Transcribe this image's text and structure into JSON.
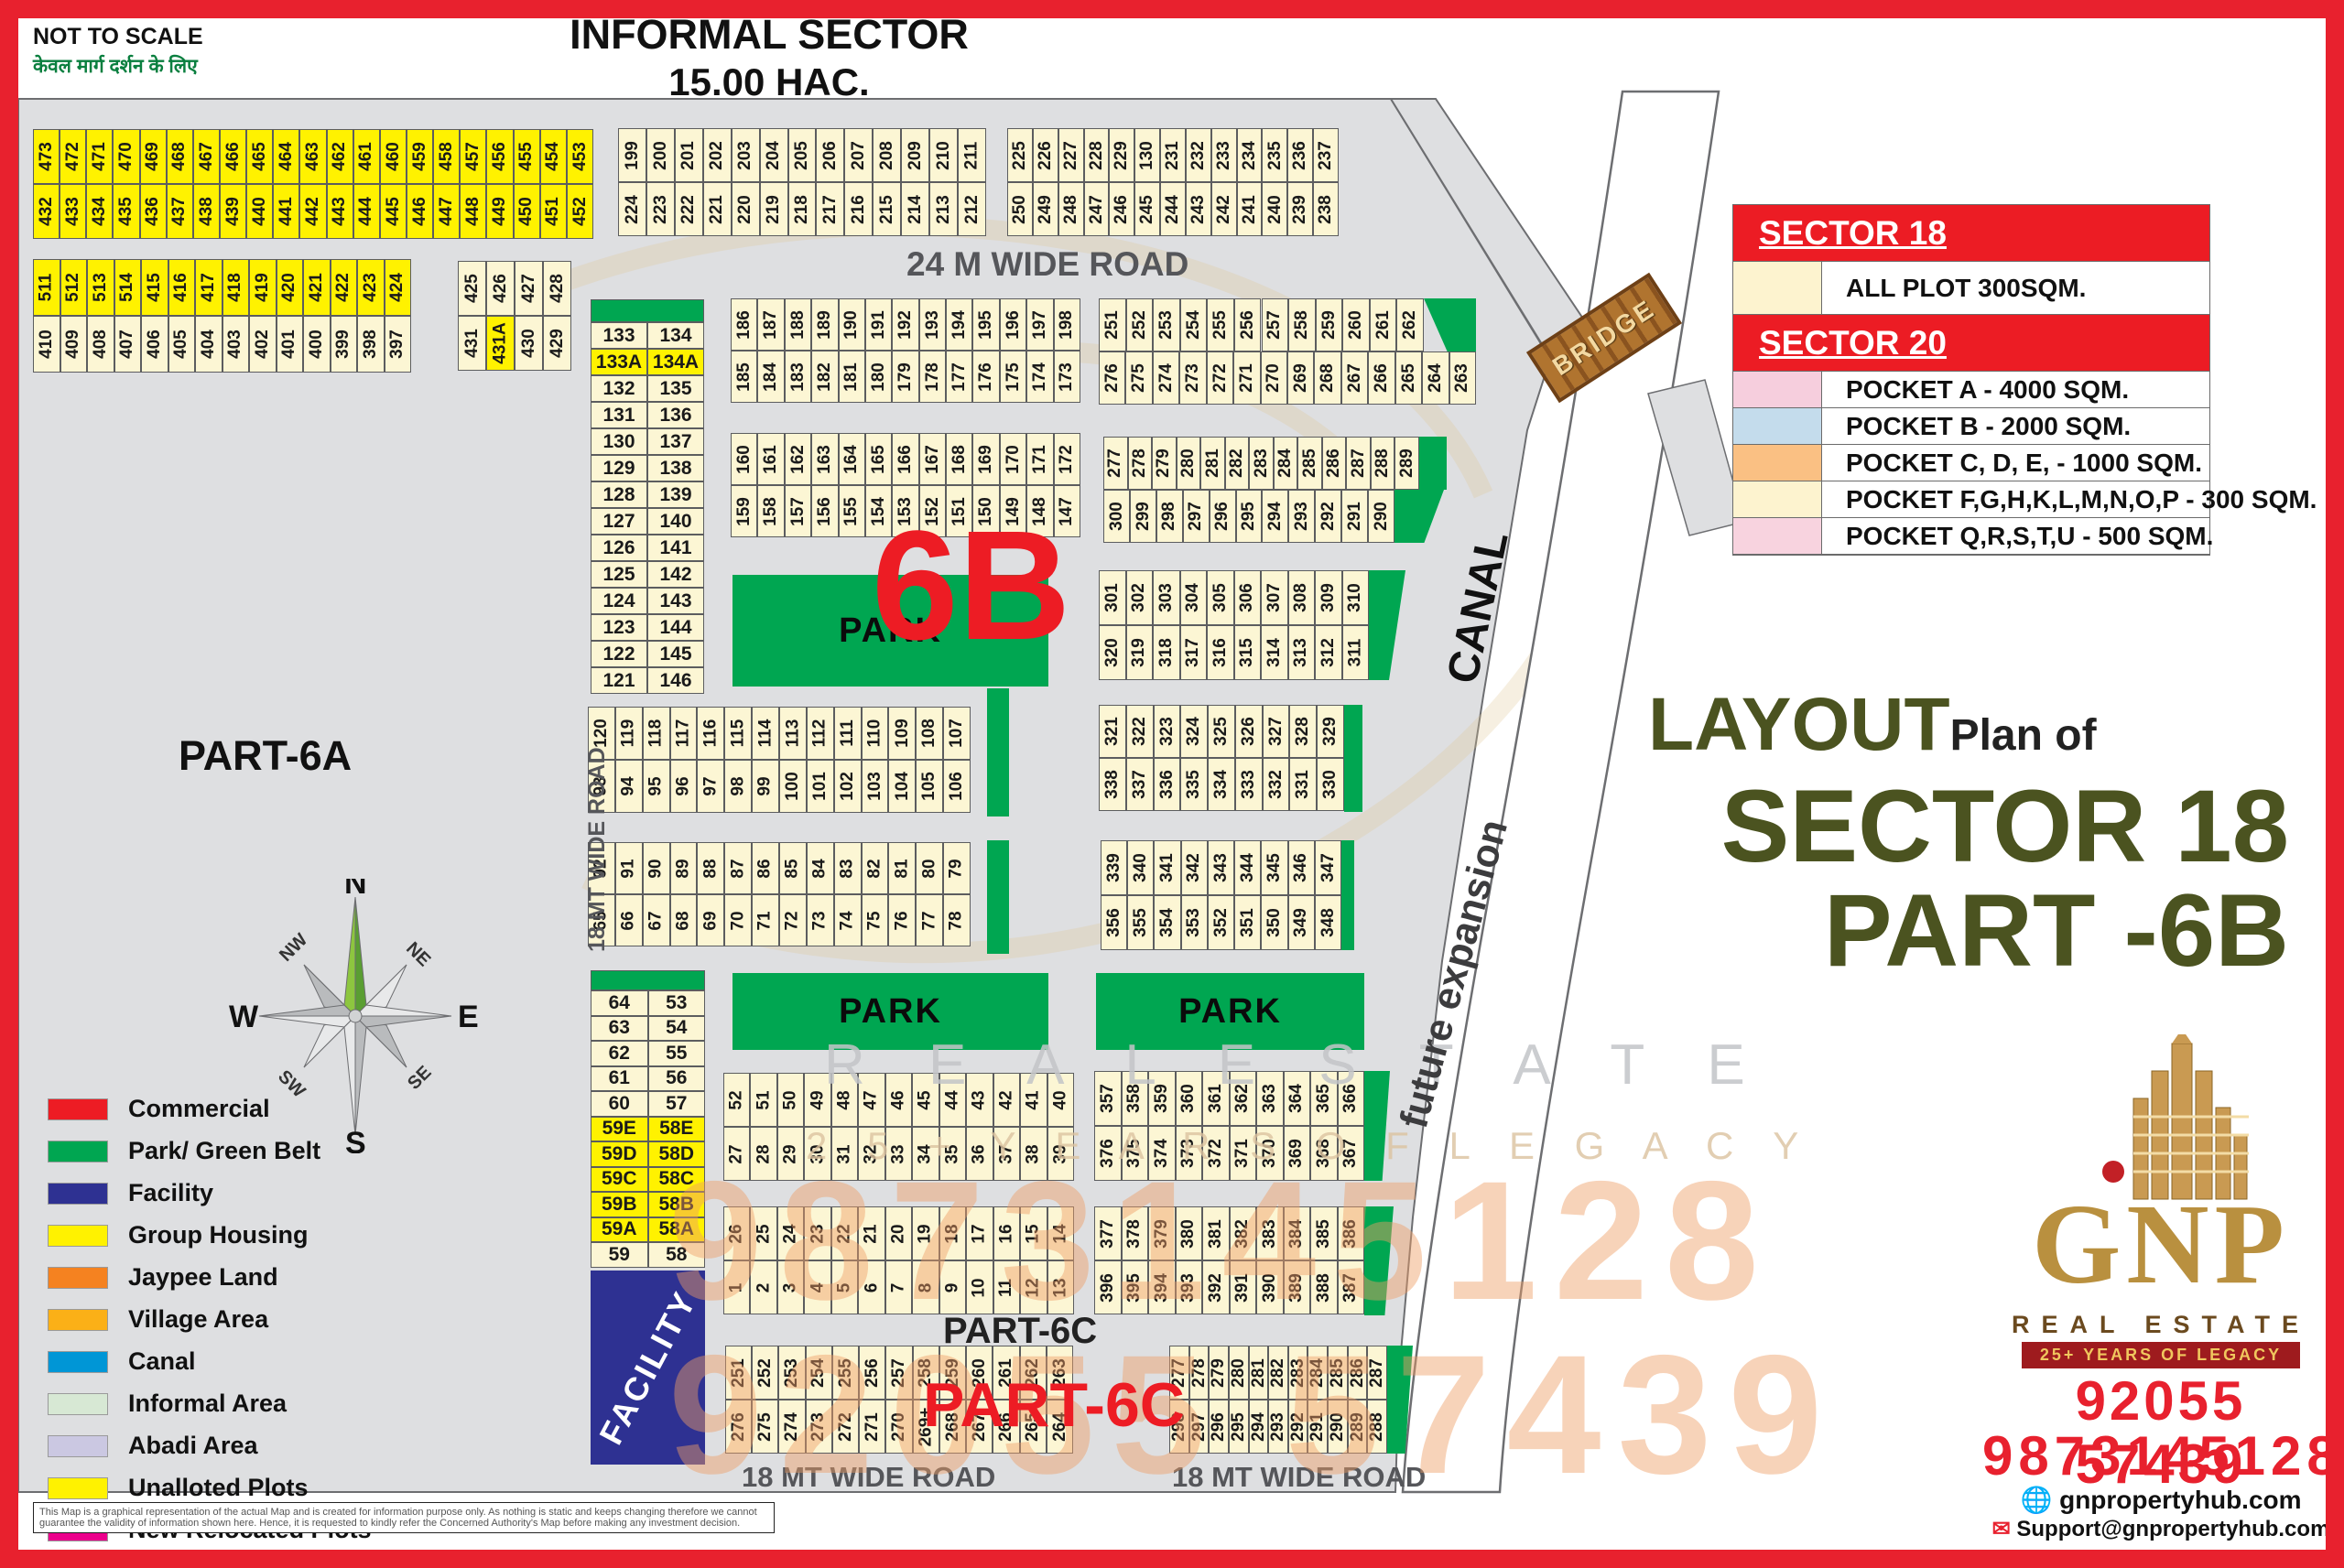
{
  "labels": {
    "not_to_scale": "NOT TO SCALE",
    "hindi": "केवल मार्ग दर्शन के लिए",
    "informal_1": "INFORMAL SECTOR",
    "informal_2": "15.00 HAC.",
    "road24": "24 M WIDE ROAD",
    "road18v": "18 MT WIDE ROAD",
    "road18a": "18 MT WIDE ROAD",
    "road18b": "18 MT WIDE ROAD",
    "part6a": "PART-6A",
    "part6c_black": "PART-6C",
    "part6c_red": "PART-6C",
    "six_b": "6B",
    "canal": "CANAL",
    "future_expansion": "future expansion",
    "bridge": "BRIDGE",
    "layout": "LAYOUT",
    "plan_of": "Plan of",
    "sector18_title": "SECTOR 18",
    "part6b_title": "PART -6B"
  },
  "compass": {
    "n": "N",
    "s": "S",
    "e": "E",
    "w": "W",
    "ne": "NE",
    "nw": "NW",
    "se": "SE",
    "sw": "SW"
  },
  "parks": [
    {
      "id": "park-6b",
      "label": "PARK"
    },
    {
      "id": "park-mid",
      "label": "PARK"
    },
    {
      "id": "park-right",
      "label": "PARK"
    }
  ],
  "facility_label": "FACILITY",
  "plot_blocks": [
    {
      "id": "b1",
      "kind": "slat",
      "yellow": "all",
      "rows": [
        [
          "473",
          "472",
          "471",
          "470",
          "469",
          "468",
          "467",
          "466",
          "465",
          "464",
          "463",
          "462",
          "461",
          "460",
          "459",
          "458",
          "457",
          "456",
          "455",
          "454",
          "453"
        ],
        [
          "432",
          "433",
          "434",
          "435",
          "436",
          "437",
          "438",
          "439",
          "440",
          "441",
          "442",
          "443",
          "444",
          "445",
          "446",
          "447",
          "448",
          "449",
          "450",
          "451",
          "452"
        ]
      ]
    },
    {
      "id": "b2",
      "kind": "slat",
      "yellowRows": [
        0
      ],
      "rows": [
        [
          "511",
          "512",
          "513",
          "514",
          "415",
          "416",
          "417",
          "418",
          "419",
          "420",
          "421",
          "422",
          "423",
          "424"
        ],
        [
          "410",
          "409",
          "408",
          "407",
          "406",
          "405",
          "404",
          "403",
          "402",
          "401",
          "400",
          "399",
          "398",
          "397"
        ]
      ]
    },
    {
      "id": "b3",
      "kind": "slat",
      "yellowCells": [
        "431A"
      ],
      "rows": [
        [
          "425",
          "426",
          "427",
          "428"
        ],
        [
          "431",
          "431A",
          "430",
          "429"
        ]
      ]
    },
    {
      "id": "b4",
      "kind": "slat",
      "rows": [
        [
          "199",
          "200",
          "201",
          "202",
          "203",
          "204",
          "205",
          "206",
          "207",
          "208",
          "209",
          "210",
          "211"
        ],
        [
          "224",
          "223",
          "222",
          "221",
          "220",
          "219",
          "218",
          "217",
          "216",
          "215",
          "214",
          "213",
          "212"
        ]
      ]
    },
    {
      "id": "b5",
      "kind": "slat",
      "rows": [
        [
          "225",
          "226",
          "227",
          "228",
          "229",
          "130",
          "231",
          "232",
          "233",
          "234",
          "235",
          "236",
          "237"
        ],
        [
          "250",
          "249",
          "248",
          "247",
          "246",
          "245",
          "244",
          "243",
          "242",
          "241",
          "240",
          "239",
          "238"
        ]
      ]
    },
    {
      "id": "c1",
      "kind": "table",
      "yellowCells": [
        "133A",
        "134A"
      ],
      "rows": [
        [
          "133",
          "134"
        ],
        [
          "133A",
          "134A"
        ],
        [
          "132",
          "135"
        ],
        [
          "131",
          "136"
        ],
        [
          "130",
          "137"
        ],
        [
          "129",
          "138"
        ],
        [
          "128",
          "139"
        ],
        [
          "127",
          "140"
        ],
        [
          "126",
          "141"
        ],
        [
          "125",
          "142"
        ],
        [
          "124",
          "143"
        ],
        [
          "123",
          "144"
        ],
        [
          "122",
          "145"
        ],
        [
          "121",
          "146"
        ]
      ]
    },
    {
      "id": "c2",
      "kind": "slat",
      "rows": [
        [
          "186",
          "187",
          "188",
          "189",
          "190",
          "191",
          "192",
          "193",
          "194",
          "195",
          "196",
          "197",
          "198"
        ],
        [
          "185",
          "184",
          "183",
          "182",
          "181",
          "180",
          "179",
          "178",
          "177",
          "176",
          "175",
          "174",
          "173"
        ]
      ]
    },
    {
      "id": "c3",
      "kind": "slat",
      "rows": [
        [
          "160",
          "161",
          "162",
          "163",
          "164",
          "165",
          "166",
          "167",
          "168",
          "169",
          "170",
          "171",
          "172"
        ],
        [
          "159",
          "158",
          "157",
          "156",
          "155",
          "154",
          "153",
          "152",
          "151",
          "150",
          "149",
          "148",
          "147"
        ]
      ]
    },
    {
      "id": "c4",
      "kind": "slat",
      "rows": [
        [
          "251",
          "252",
          "253",
          "254",
          "255",
          "256",
          "257",
          "258",
          "259",
          "260",
          "261",
          "262"
        ],
        [
          "276",
          "275",
          "274",
          "273",
          "272",
          "271",
          "270",
          "269",
          "268",
          "267",
          "266",
          "265",
          "264",
          "263"
        ]
      ]
    },
    {
      "id": "c5",
      "kind": "slat",
      "rows": [
        [
          "277",
          "278",
          "279",
          "280",
          "281",
          "282",
          "283",
          "284",
          "285",
          "286",
          "287",
          "288",
          "289"
        ],
        [
          "300",
          "299",
          "298",
          "297",
          "296",
          "295",
          "294",
          "293",
          "292",
          "291",
          "290"
        ]
      ]
    },
    {
      "id": "c6",
      "kind": "slat",
      "rows": [
        [
          "301",
          "302",
          "303",
          "304",
          "305",
          "306",
          "307",
          "308",
          "309",
          "310"
        ],
        [
          "320",
          "319",
          "318",
          "317",
          "316",
          "315",
          "314",
          "313",
          "312",
          "311"
        ]
      ]
    },
    {
      "id": "c7",
      "kind": "slat",
      "rows": [
        [
          "321",
          "322",
          "323",
          "324",
          "325",
          "326",
          "327",
          "328",
          "329"
        ],
        [
          "338",
          "337",
          "336",
          "335",
          "334",
          "333",
          "332",
          "331",
          "330"
        ]
      ]
    },
    {
      "id": "c8",
      "kind": "slat",
      "rows": [
        [
          "120",
          "119",
          "118",
          "117",
          "116",
          "115",
          "114",
          "113",
          "112",
          "111",
          "110",
          "109",
          "108",
          "107"
        ],
        [
          "93",
          "94",
          "95",
          "96",
          "97",
          "98",
          "99",
          "100",
          "101",
          "102",
          "103",
          "104",
          "105",
          "106"
        ]
      ]
    },
    {
      "id": "c9",
      "kind": "slat",
      "rows": [
        [
          "92",
          "91",
          "90",
          "89",
          "88",
          "87",
          "86",
          "85",
          "84",
          "83",
          "82",
          "81",
          "80",
          "79"
        ],
        [
          "65",
          "66",
          "67",
          "68",
          "69",
          "70",
          "71",
          "72",
          "73",
          "74",
          "75",
          "76",
          "77",
          "78"
        ]
      ]
    },
    {
      "id": "c10",
      "kind": "slat",
      "rows": [
        [
          "339",
          "340",
          "341",
          "342",
          "343",
          "344",
          "345",
          "346",
          "347"
        ],
        [
          "356",
          "355",
          "354",
          "353",
          "352",
          "351",
          "350",
          "349",
          "348"
        ]
      ]
    },
    {
      "id": "c11",
      "kind": "table",
      "yellowCells": [
        "59E",
        "58E",
        "59D",
        "58D",
        "59C",
        "58C",
        "59B",
        "58B",
        "59A",
        "58A"
      ],
      "rows": [
        [
          "64",
          "53"
        ],
        [
          "63",
          "54"
        ],
        [
          "62",
          "55"
        ],
        [
          "61",
          "56"
        ],
        [
          "60",
          "57"
        ],
        [
          "59E",
          "58E"
        ],
        [
          "59D",
          "58D"
        ],
        [
          "59C",
          "58C"
        ],
        [
          "59B",
          "58B"
        ],
        [
          "59A",
          "58A"
        ],
        [
          "59",
          "58"
        ]
      ]
    },
    {
      "id": "c12",
      "kind": "slat",
      "rows": [
        [
          "52",
          "51",
          "50",
          "49",
          "48",
          "47",
          "46",
          "45",
          "44",
          "43",
          "42",
          "41",
          "40"
        ],
        [
          "27",
          "28",
          "29",
          "30",
          "31",
          "32",
          "33",
          "34",
          "35",
          "36",
          "37",
          "38",
          "39"
        ]
      ]
    },
    {
      "id": "c13",
      "kind": "slat",
      "rows": [
        [
          "26",
          "25",
          "24",
          "23",
          "22",
          "21",
          "20",
          "19",
          "18",
          "17",
          "16",
          "15",
          "14"
        ],
        [
          "1",
          "2",
          "3",
          "4",
          "5",
          "6",
          "7",
          "8",
          "9",
          "10",
          "11",
          "12",
          "13"
        ]
      ]
    },
    {
      "id": "c14",
      "kind": "slat",
      "rows": [
        [
          "357",
          "358",
          "359",
          "360",
          "361",
          "362",
          "363",
          "364",
          "365",
          "366"
        ],
        [
          "376",
          "375",
          "374",
          "373",
          "372",
          "371",
          "370",
          "369",
          "368",
          "367"
        ]
      ]
    },
    {
      "id": "c15",
      "kind": "slat",
      "rows": [
        [
          "377",
          "378",
          "379",
          "380",
          "381",
          "382",
          "383",
          "384",
          "385",
          "386"
        ],
        [
          "396",
          "395",
          "394",
          "393",
          "392",
          "391",
          "390",
          "389",
          "388",
          "387"
        ]
      ]
    },
    {
      "id": "c16",
      "kind": "slat",
      "rows": [
        [
          "251",
          "252",
          "253",
          "254",
          "255",
          "256",
          "257",
          "258",
          "259",
          "260",
          "261",
          "262",
          "263"
        ],
        [
          "276",
          "275",
          "274",
          "273",
          "272",
          "271",
          "270",
          "269+",
          "268",
          "267",
          "266",
          "265",
          "264"
        ]
      ]
    },
    {
      "id": "c17",
      "kind": "slat",
      "rows": [
        [
          "277",
          "278",
          "279",
          "280",
          "281",
          "282",
          "283",
          "284",
          "285",
          "286",
          "287"
        ],
        [
          "298",
          "297",
          "296",
          "295",
          "294",
          "293",
          "292",
          "291",
          "290",
          "289",
          "288"
        ]
      ]
    }
  ],
  "legend": {
    "items": [
      {
        "label": "Commercial",
        "color": "#ED1C24"
      },
      {
        "label": "Park/ Green Belt",
        "color": "#00A651"
      },
      {
        "label": "Facility",
        "color": "#2E3192"
      },
      {
        "label": "Group Housing",
        "color": "#FFF200"
      },
      {
        "label": "Jaypee Land",
        "color": "#F58220"
      },
      {
        "label": "Village Area",
        "color": "#FBB017"
      },
      {
        "label": "Canal",
        "color": "#0096D6"
      },
      {
        "label": "Informal Area",
        "color": "#D7E8D4"
      },
      {
        "label": "Abadi Area",
        "color": "#CBC8E2"
      },
      {
        "label": "Unalloted Plots",
        "color": "#FFF200"
      },
      {
        "label": "New Relocated Plots",
        "color": "#EC008C"
      }
    ]
  },
  "sector_table": {
    "rows": [
      {
        "type": "header",
        "label": "SECTOR 18"
      },
      {
        "type": "item",
        "swatch": "#FDF3CF",
        "label": "ALL PLOT  300SQM."
      },
      {
        "type": "header",
        "label": "SECTOR 20"
      },
      {
        "type": "item",
        "swatch": "#F6CEDD",
        "label": "POCKET A    -   4000 SQM."
      },
      {
        "type": "item",
        "swatch": "#C4DCEC",
        "label": "POCKET B    -   2000 SQM."
      },
      {
        "type": "item",
        "swatch": "#FAC083",
        "label": "POCKET C, D, E, - 1000 SQM."
      },
      {
        "type": "item",
        "swatch": "#FDF3CF",
        "label": "POCKET  F,G,H,K,L,M,N,O,P  -  300 SQM."
      },
      {
        "type": "item",
        "swatch": "#F8D3DF",
        "label": "POCKET Q,R,S,T,U   -  500 SQM."
      }
    ]
  },
  "contact": {
    "gnp": "GNP",
    "tagline": "REAL ESTATE",
    "band": "25+ YEARS OF LEGACY",
    "phone1": "92055 57439",
    "phone2": "9873145128",
    "globe_icon": "🌐",
    "mail_icon": "✉",
    "website": "gnpropertyhub.com",
    "email": "Support@gnpropertyhub.com"
  },
  "watermarks": {
    "real_estate": "R E A L   E S T A T E",
    "legacy": "2 5 + Y E A R S   O F   L E G A C Y",
    "phone_a": "9873145128",
    "phone_b": "92055 57439"
  },
  "disclaimer": "This Map is a graphical representation of the actual Map and is created for information purpose only. As nothing is static and keeps changing therefore we cannot guarantee the validity of information shown here. Hence, it is requested to kindly refer the Concerned Authority's Map before making any investment decision."
}
